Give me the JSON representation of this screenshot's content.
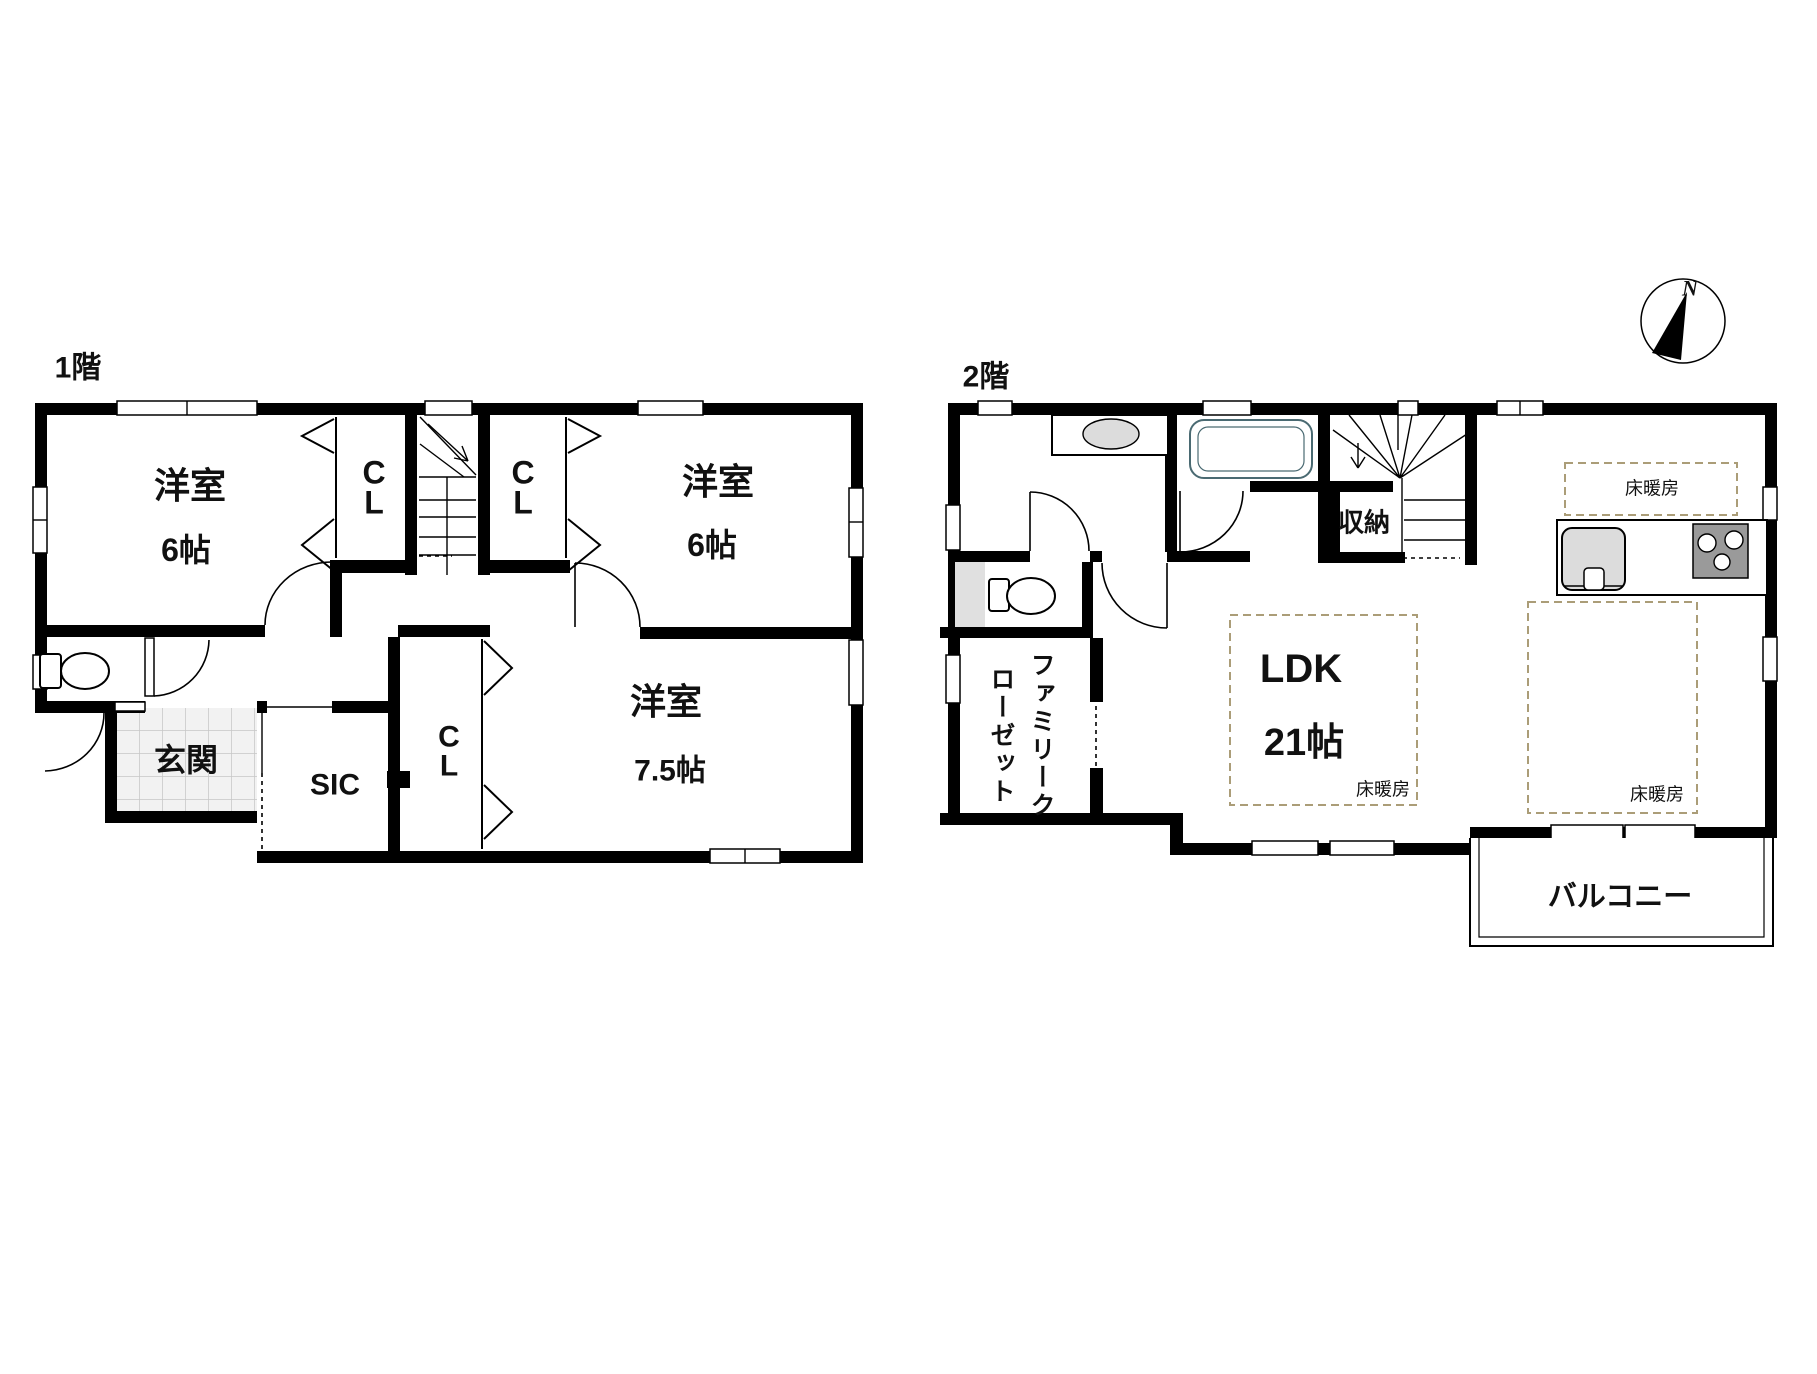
{
  "title": "間取り図",
  "colors": {
    "wall": "#000000",
    "background": "#ffffff",
    "heating_dash": "#ab9d78",
    "tile_fill": "#f2f2f2",
    "tile_line": "#c6c6c6",
    "fixture_gray": "#e0e0e0",
    "sink_gray": "#dcdcdc",
    "stove_gray": "#9a9a9a",
    "tub_line": "#4a6a72"
  },
  "compass": {
    "north_label": "N"
  },
  "floor1": {
    "label": "1階",
    "room_nw": {
      "name": "洋室",
      "size": "6帖"
    },
    "room_ne": {
      "name": "洋室",
      "size": "6帖"
    },
    "room_s": {
      "name": "洋室",
      "size": "7.5帖"
    },
    "closet_nw": "CL",
    "closet_ne": "CL",
    "closet_s": "CL",
    "entrance": "玄関",
    "shoe_closet": "SIC"
  },
  "floor2": {
    "label": "2階",
    "ldk": {
      "name": "LDK",
      "size": "21帖"
    },
    "storage": "収納",
    "family_closet": "ファミリークローゼット",
    "balcony": "バルコニー",
    "floor_heating": "床暖房"
  }
}
